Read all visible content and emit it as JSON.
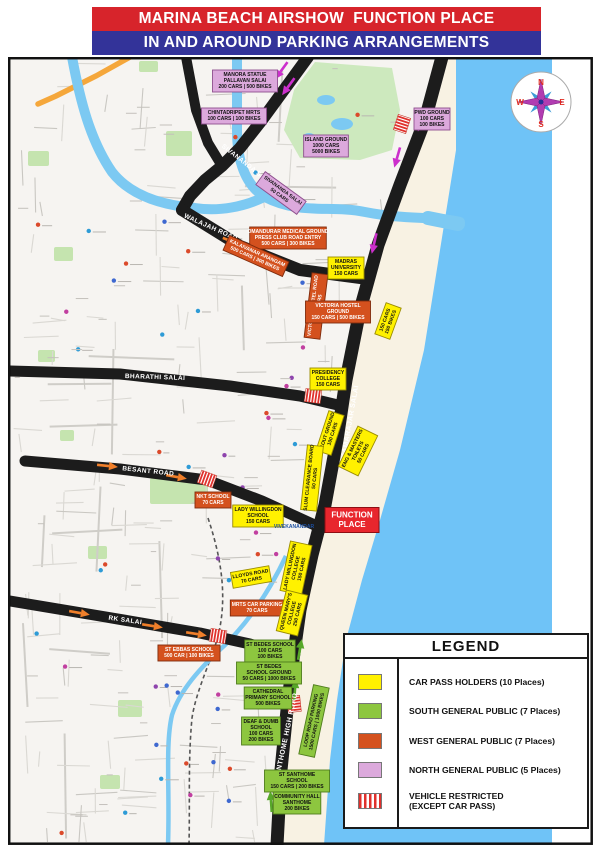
{
  "title": {
    "line1": "MARINA BEACH AIRSHOW  FUNCTION PLACE",
    "line2": "IN AND AROUND PARKING ARRANGEMENTS"
  },
  "colors": {
    "title_bar_red": "#D7242B",
    "title_bar_blue": "#333399",
    "sea": "#6FC3F7",
    "river": "#7CC9F2",
    "beach": "#F8F2E3",
    "land": "#F6F4F1",
    "park": "#C5E4AF",
    "road": "#1C1C1C",
    "car_pass": "#FFF100",
    "south": "#8DC63F",
    "west": "#D4511E",
    "north": "#DCA9DC",
    "restricted": "#E0312C",
    "function_place": "#E8262D",
    "arrow_north_flow": "#CC2FCC",
    "arrow_west_flow": "#F07F2A",
    "arrow_south_flow": "#57A829"
  },
  "legend": {
    "title": "LEGEND",
    "items": [
      {
        "id": "car_pass",
        "style": "solid",
        "lines": [
          "CAR PASS HOLDERS (10 Places)"
        ]
      },
      {
        "id": "south",
        "style": "solid",
        "lines": [
          "SOUTH GENERAL PUBLIC (7 Places)"
        ]
      },
      {
        "id": "west",
        "style": "solid",
        "lines": [
          "WEST GENERAL PUBLIC (7 Places)"
        ]
      },
      {
        "id": "north",
        "style": "solid",
        "lines": [
          "NORTH GENERAL PUBLIC (5 Places)"
        ]
      },
      {
        "id": "restricted",
        "style": "striped",
        "lines": [
          "VEHICLE RESTRICTED",
          "(EXCEPT CAR PASS)"
        ]
      }
    ]
  },
  "compass": {
    "n": "N",
    "e": "E",
    "s": "S",
    "w": "W"
  },
  "map": {
    "function_place": {
      "lines": [
        "FUNCTION",
        "PLACE"
      ],
      "x": 352,
      "y": 520
    },
    "road_labels": [
      {
        "text": "KAMARAJAR SALAI",
        "x": 352,
        "y": 422,
        "rot": -80,
        "size": 7
      },
      {
        "text": "SANTHOME HIGH ROAD",
        "x": 288,
        "y": 737,
        "rot": -78,
        "size": 7
      },
      {
        "text": "BHARATHI SALAI",
        "x": 155,
        "y": 379,
        "rot": 2,
        "size": 6.5
      },
      {
        "text": "BESANT ROAD",
        "x": 148,
        "y": 473,
        "rot": 6,
        "size": 6.5
      },
      {
        "text": "RK SALAI",
        "x": 125,
        "y": 622,
        "rot": 8,
        "size": 6.5
      },
      {
        "text": "WALAJAH ROAD",
        "x": 210,
        "y": 229,
        "rot": 24,
        "size": 6.5
      },
      {
        "text": "SIVANANDA SALAI",
        "x": 247,
        "y": 167,
        "rot": 38,
        "size": 6.5
      }
    ],
    "poi_labels": [
      {
        "text": "VIVEKANANDAR",
        "x": 294,
        "y": 528
      }
    ],
    "parking_labels": [
      {
        "category": "north",
        "lines": [
          "MANORA STATUE",
          "PALLAVAN SALAI",
          "200 CARS | 500 BIKES"
        ],
        "x": 245,
        "y": 81,
        "rot": 0
      },
      {
        "category": "north",
        "lines": [
          "CHINTADRIPET MRTS",
          "100 CARS | 100 BIKES"
        ],
        "x": 234,
        "y": 116,
        "rot": 0
      },
      {
        "category": "north",
        "lines": [
          "ISLAND GROUND",
          "1000 CARS",
          "5000 BIKES"
        ],
        "x": 326,
        "y": 146,
        "rot": 0
      },
      {
        "category": "north",
        "lines": [
          "PWD GROUND",
          "100 CARS",
          "100 BIKES"
        ],
        "x": 432,
        "y": 119,
        "rot": 0
      },
      {
        "category": "north",
        "lines": [
          "SIVANANDA SALAI",
          "50 CARS"
        ],
        "x": 281,
        "y": 193,
        "rot": 36
      },
      {
        "category": "west",
        "lines": [
          "OMANDURAR MEDICAL GROUND",
          "PRESS CLUB ROAD ENTRY",
          "500 CARS | 300 BIKES"
        ],
        "x": 288,
        "y": 238,
        "rot": 0
      },
      {
        "category": "west",
        "lines": [
          "KALAIVANAR ARANGAM",
          "500 CARS | 300 BIKES"
        ],
        "x": 256,
        "y": 256,
        "rot": 24
      },
      {
        "category": "west",
        "lines": [
          "VICTORIA HOSTEL ROAD",
          "150 CARS"
        ],
        "x": 316,
        "y": 306,
        "rot": -83
      },
      {
        "category": "west",
        "lines": [
          "VICTORIA HOSTEL",
          "GROUND",
          "150 CARS | 500 BIKES"
        ],
        "x": 338,
        "y": 312,
        "rot": 0
      },
      {
        "category": "west",
        "lines": [
          "NKT SCHOOL",
          "70 CARS"
        ],
        "x": 213,
        "y": 500,
        "rot": 0
      },
      {
        "category": "west",
        "lines": [
          "MRTS CAR PARKING",
          "70 CARS"
        ],
        "x": 257,
        "y": 608,
        "rot": 0
      },
      {
        "category": "west",
        "lines": [
          "ST EBBAS SCHOOL",
          "500 CAR | 100 BIKES"
        ],
        "x": 189,
        "y": 653,
        "rot": 0
      },
      {
        "category": "south",
        "lines": [
          "ST BEDES SCHOOL",
          "100 CARS",
          "100 BIKES"
        ],
        "x": 270,
        "y": 651,
        "rot": 0
      },
      {
        "category": "south",
        "lines": [
          "ST BEDES",
          "SCHOOL GROUND",
          "50 CARS | 1000 BIKES"
        ],
        "x": 269,
        "y": 673,
        "rot": 0
      },
      {
        "category": "south",
        "lines": [
          "CATHEDRAL",
          "PRIMARY SCHOOL",
          "500 BIKES"
        ],
        "x": 268,
        "y": 698,
        "rot": 0
      },
      {
        "category": "south",
        "lines": [
          "DEAF & DUMB",
          "SCHOOL",
          "100 CARS",
          "200 BIKES"
        ],
        "x": 261,
        "y": 731,
        "rot": 0
      },
      {
        "category": "south",
        "lines": [
          "LOOP ROAD PARKING",
          "1500 CARS | 1000 BIKES"
        ],
        "x": 314,
        "y": 721,
        "rot": -78
      },
      {
        "category": "south",
        "lines": [
          "ST SANTHOME",
          "SCHOOL",
          "150 CARS | 200 BIKES"
        ],
        "x": 297,
        "y": 781,
        "rot": 0
      },
      {
        "category": "south",
        "lines": [
          "COMMUNITY HALL",
          "SANTHOME",
          "200 BIKES"
        ],
        "x": 297,
        "y": 803,
        "rot": 0
      },
      {
        "category": "car_pass",
        "lines": [
          "MADRAS",
          "UNIVERSITY",
          "150 CARS"
        ],
        "x": 346,
        "y": 268,
        "rot": 0
      },
      {
        "category": "car_pass",
        "lines": [
          "150 CARS",
          "150 BIKES"
        ],
        "x": 388,
        "y": 321,
        "rot": -70
      },
      {
        "category": "car_pass",
        "lines": [
          "PRESIDENCY",
          "COLLEGE",
          "150 CARS"
        ],
        "x": 328,
        "y": 379,
        "rot": 0
      },
      {
        "category": "car_pass",
        "lines": [
          "SCOUT GROUND",
          "100 CARS"
        ],
        "x": 330,
        "y": 433,
        "rot": -72
      },
      {
        "category": "car_pass",
        "lines": [
          "ENG & MASTERS",
          "TOILETS",
          "50 CARS"
        ],
        "x": 358,
        "y": 451,
        "rot": -64
      },
      {
        "category": "car_pass",
        "lines": [
          "SLUM CLEARANCE BOARD",
          "50 CARS"
        ],
        "x": 312,
        "y": 478,
        "rot": -84
      },
      {
        "category": "car_pass",
        "lines": [
          "LADY WILLINGDON",
          "SCHOOL",
          "150 CARS"
        ],
        "x": 258,
        "y": 516,
        "rot": 0
      },
      {
        "category": "car_pass",
        "lines": [
          "LADY WILLINGDON",
          "COLLEGE",
          "150 CARS"
        ],
        "x": 296,
        "y": 568,
        "rot": -78
      },
      {
        "category": "car_pass",
        "lines": [
          "LLOYDS ROAD",
          "70 CARS"
        ],
        "x": 251,
        "y": 577,
        "rot": -10
      },
      {
        "category": "car_pass",
        "lines": [
          "QUEEN MARY'S",
          "COLLEGE",
          "250 CARS"
        ],
        "x": 292,
        "y": 613,
        "rot": -76
      }
    ]
  }
}
